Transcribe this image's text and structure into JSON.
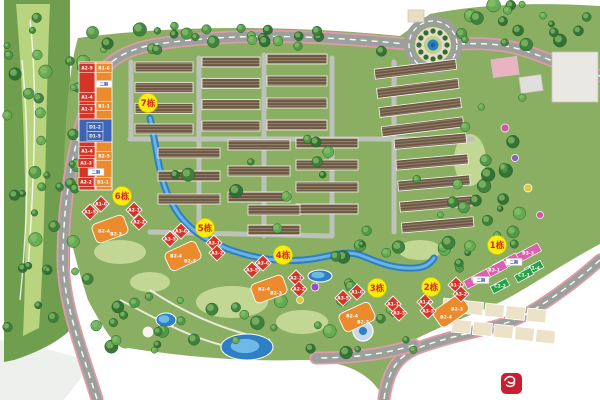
{
  "title": "residential-masterplan-site-plan",
  "colors": {
    "canvas": "#ffffff",
    "plan_green": "#8aaf62",
    "lawn_light": "#c9dc9b",
    "golf_dark": "#6f9e4f",
    "golf_fairway": "#b9d47f",
    "road_grey": "#9ba09b",
    "road_minor": "#bdc3ba",
    "road_pink_edge": "#e09aa8",
    "water_deep": "#2f7fc4",
    "water_light": "#6fb9e6",
    "roof_dark": "#6d5846",
    "roof_stripe": "#94816b",
    "unit_red": "#d63426",
    "unit_orange": "#ec8a2e",
    "unit_blue": "#3f63b5",
    "unit_pink": "#dd5fae",
    "unit_green": "#27a347",
    "terrace_beige": "#ece2c8",
    "marker_yellow": "#f7ee12",
    "marker_text": "#e0221a",
    "logo_red": "#c51f30",
    "tree_greens": [
      "#3c7f3a",
      "#4f9647",
      "#63ab52",
      "#2f6e33"
    ]
  },
  "markers": [
    {
      "label": "7栋",
      "x": 148,
      "y": 103
    },
    {
      "label": "6栋",
      "x": 122,
      "y": 196
    },
    {
      "label": "5栋",
      "x": 205,
      "y": 228
    },
    {
      "label": "4栋",
      "x": 283,
      "y": 255
    },
    {
      "label": "3栋",
      "x": 377,
      "y": 288
    },
    {
      "label": "2栋",
      "x": 431,
      "y": 287
    },
    {
      "label": "1栋",
      "x": 497,
      "y": 245
    }
  ],
  "tower_bars": [
    {
      "x": 79,
      "y": 62,
      "w": 16,
      "h": 128,
      "c": "red"
    },
    {
      "x": 96,
      "y": 62,
      "w": 16,
      "h": 128,
      "c": "orange"
    },
    {
      "x": 79,
      "y": 119,
      "w": 33,
      "h": 23,
      "c": "blue"
    }
  ],
  "tower_chips": [
    {
      "label": "A2-5",
      "x": 87,
      "y": 68,
      "c": "red"
    },
    {
      "label": "B1-6",
      "x": 104,
      "y": 68,
      "c": "orange"
    },
    {
      "label": "A1-4",
      "x": 87,
      "y": 97,
      "c": "red"
    },
    {
      "label": "A1-3",
      "x": 87,
      "y": 109,
      "c": "red"
    },
    {
      "label": "B1-1",
      "x": 104,
      "y": 106,
      "c": "orange"
    },
    {
      "label": "D1-2",
      "x": 95,
      "y": 127,
      "c": "blue"
    },
    {
      "label": "D1-5",
      "x": 95,
      "y": 136,
      "c": "blue"
    },
    {
      "label": "A1-4",
      "x": 87,
      "y": 151,
      "c": "red"
    },
    {
      "label": "B2-5",
      "x": 104,
      "y": 156,
      "c": "orange"
    },
    {
      "label": "A1-3",
      "x": 86,
      "y": 163,
      "c": "red"
    },
    {
      "label": "A2-2",
      "x": 86,
      "y": 182,
      "c": "red"
    },
    {
      "label": "B1-1",
      "x": 103,
      "y": 182,
      "c": "orange"
    }
  ],
  "diamonds": [
    {
      "label": "A1-6",
      "x": 101,
      "y": 204
    },
    {
      "label": "A1-5",
      "x": 90,
      "y": 212
    },
    {
      "label": "A2-1",
      "x": 134,
      "y": 210
    },
    {
      "label": "A2-2",
      "x": 139,
      "y": 222
    },
    {
      "label": "A3-6",
      "x": 181,
      "y": 231
    },
    {
      "label": "A3-5",
      "x": 170,
      "y": 239
    },
    {
      "label": "A3-1",
      "x": 214,
      "y": 243
    },
    {
      "label": "A3-2",
      "x": 217,
      "y": 253
    },
    {
      "label": "A3-6",
      "x": 263,
      "y": 263
    },
    {
      "label": "A3-5",
      "x": 252,
      "y": 270
    },
    {
      "label": "A2-1",
      "x": 296,
      "y": 278
    },
    {
      "label": "A2-2",
      "x": 299,
      "y": 289
    },
    {
      "label": "A1-6",
      "x": 357,
      "y": 292
    },
    {
      "label": "A3-5",
      "x": 343,
      "y": 298
    },
    {
      "label": "A1-1",
      "x": 393,
      "y": 304
    },
    {
      "label": "A3-3",
      "x": 399,
      "y": 313
    },
    {
      "label": "A1-1",
      "x": 456,
      "y": 285
    },
    {
      "label": "A3-2",
      "x": 461,
      "y": 294
    },
    {
      "label": "A1-6",
      "x": 425,
      "y": 302
    },
    {
      "label": "A3-5",
      "x": 428,
      "y": 311
    }
  ],
  "orange_blobs": [
    {
      "x": 110,
      "y": 229,
      "rot": -20
    },
    {
      "x": 183,
      "y": 256,
      "rot": -25
    },
    {
      "x": 269,
      "y": 289,
      "rot": -20
    },
    {
      "x": 357,
      "y": 317,
      "rot": -25
    },
    {
      "x": 451,
      "y": 311,
      "rot": -35
    }
  ],
  "orange_units": [
    {
      "label": "B2-4",
      "x": 104,
      "y": 231
    },
    {
      "label": "B2-3",
      "x": 116,
      "y": 234
    },
    {
      "label": "B2-4",
      "x": 176,
      "y": 256
    },
    {
      "label": "B2-3",
      "x": 190,
      "y": 261
    },
    {
      "label": "B2-4",
      "x": 264,
      "y": 289
    },
    {
      "label": "B2-3",
      "x": 276,
      "y": 293
    },
    {
      "label": "B2-4",
      "x": 352,
      "y": 316
    },
    {
      "label": "B2-3",
      "x": 363,
      "y": 322
    },
    {
      "label": "B2-3",
      "x": 457,
      "y": 309
    },
    {
      "label": "B2-4",
      "x": 446,
      "y": 317
    }
  ],
  "pink_blocks": [
    {
      "label": "B3-3",
      "x": 528,
      "y": 253
    },
    {
      "label": "B3-2",
      "x": 506,
      "y": 263
    },
    {
      "label": "B3-1",
      "x": 494,
      "y": 270
    },
    {
      "label": "B3-2",
      "x": 477,
      "y": 279
    }
  ],
  "green_blocks": [
    {
      "label": "C1-4",
      "x": 534,
      "y": 268
    },
    {
      "label": "C1-1",
      "x": 524,
      "y": 275
    },
    {
      "label": "C1-2",
      "x": 500,
      "y": 286
    }
  ],
  "phase_tags": [
    {
      "label": "二期",
      "x": 104,
      "y": 84
    },
    {
      "label": "二期",
      "x": 96,
      "y": 172
    },
    {
      "label": "二期",
      "x": 514,
      "y": 262
    },
    {
      "label": "二期",
      "x": 481,
      "y": 280
    }
  ],
  "map": {
    "base_blob": "M78,38 C180,24 300,26 400,36 L430,14 C480,4 540,2 600,6 L600,244 C566,262 540,280 512,296 C478,314 448,322 414,340 C400,350 392,368 386,399 L384,399 C370,370 340,360 300,360 C240,362 180,356 128,348 C118,352 104,330 88,300 C72,250 62,210 64,160 C66,110 70,64 78,38 Z",
    "corner_shade": "M0,340 C30,344 60,352 92,362 C80,380 70,392 64,400 L0,400 Z",
    "golf": {
      "outer": "M4,0 L70,0 L70,330 C56,344 32,354 14,360 L4,362 Z",
      "fairway": "M16,4 L50,4 C45,120 46,230 39,328 L23,336 C28,230 25,110 16,4 Z",
      "paths": [
        "M30,20 C38,90 34,180 28,270",
        "M22,60 C30,140 28,220 20,300"
      ]
    },
    "roads_main": [
      "M97,399 C80,345 63,302 63,258 C63,205 72,148 90,96 C98,68 118,50 158,44 C240,32 320,36 407,44",
      "M459,44 C500,42 520,48 545,58 C565,66 585,72 600,76",
      "M384,399 C388,370 398,356 418,348 C460,332 500,330 530,312 C560,294 582,276 600,260",
      "M414,345 C386,354 352,358 316,358"
    ],
    "roads_minor": [
      "M130,139 L472,139",
      "M199,58 L199,232",
      "M264,55 L264,236",
      "M332,58 L332,236",
      "M394,62 L394,232",
      "M131,62 L131,139",
      "M150,232 L330,236"
    ],
    "leisure_paths": [
      "M120,300 C160,320 200,346 260,352",
      "M150,290 C180,310 220,330 270,340"
    ],
    "stream": "M150,118 C158,152 158,180 174,207 C186,228 205,240 228,249 C258,260 285,263 312,259 C332,256 345,250 360,255 C378,262 392,269 414,268 C424,268 430,264 434,258",
    "ponds": [
      {
        "x": 247,
        "y": 347,
        "rx": 26,
        "ry": 13
      },
      {
        "x": 166,
        "y": 320,
        "rx": 10,
        "ry": 7
      },
      {
        "x": 320,
        "y": 276,
        "rx": 12,
        "ry": 6
      }
    ],
    "fountain": {
      "x": 363,
      "y": 331,
      "r": 10
    },
    "lawns": [
      {
        "x": 120,
        "y": 252,
        "rx": 26,
        "ry": 12
      },
      {
        "x": 232,
        "y": 302,
        "rx": 36,
        "ry": 16
      },
      {
        "x": 302,
        "y": 322,
        "rx": 26,
        "ry": 12
      },
      {
        "x": 150,
        "y": 282,
        "rx": 20,
        "ry": 10
      },
      {
        "x": 420,
        "y": 250,
        "rx": 22,
        "ry": 10
      },
      {
        "x": 470,
        "y": 160,
        "rx": 16,
        "ry": 26
      }
    ],
    "clusters": [
      {
        "x": 135,
        "y": 62,
        "w": 58,
        "h": 72,
        "rows": 4,
        "rot": 0
      },
      {
        "x": 202,
        "y": 57,
        "w": 58,
        "h": 74,
        "rows": 4,
        "rot": 0
      },
      {
        "x": 267,
        "y": 54,
        "w": 60,
        "h": 76,
        "rows": 4,
        "rot": 0
      },
      {
        "x": 378,
        "y": 64,
        "w": 82,
        "h": 68,
        "rows": 4,
        "rot": -7
      },
      {
        "x": 158,
        "y": 148,
        "w": 62,
        "h": 56,
        "rows": 3,
        "rot": 0
      },
      {
        "x": 228,
        "y": 140,
        "w": 62,
        "h": 62,
        "rows": 3,
        "rot": 0
      },
      {
        "x": 296,
        "y": 138,
        "w": 62,
        "h": 76,
        "rows": 4,
        "rot": 0
      },
      {
        "x": 398,
        "y": 136,
        "w": 72,
        "h": 94,
        "rows": 5,
        "rot": -5
      },
      {
        "x": 248,
        "y": 205,
        "w": 52,
        "h": 30,
        "rows": 2,
        "rot": 0
      }
    ],
    "terrace_rows": [
      {
        "sx": 443,
        "sy": 299,
        "n": 5,
        "dx": 21,
        "dy": 2.5,
        "w": 19,
        "h": 13,
        "rot": 6
      },
      {
        "sx": 452,
        "sy": 320,
        "n": 5,
        "dx": 21,
        "dy": 2.5,
        "w": 19,
        "h": 13,
        "rot": 6
      }
    ],
    "structures": [
      {
        "x": 552,
        "y": 52,
        "w": 46,
        "h": 50,
        "c": "#eae8e2",
        "rot": 0
      },
      {
        "x": 492,
        "y": 58,
        "w": 26,
        "h": 18,
        "c": "#e9b3c4",
        "rot": -8
      },
      {
        "x": 520,
        "y": 76,
        "w": 22,
        "h": 16,
        "c": "#e2dede",
        "rot": -8
      },
      {
        "x": 408,
        "y": 10,
        "w": 16,
        "h": 12,
        "c": "#e8dfc2",
        "rot": 0
      }
    ],
    "roundabout": {
      "cx": 433,
      "cy": 45
    },
    "amenities": [
      {
        "x": 505,
        "y": 128,
        "c": "#cf58a6",
        "r": 4
      },
      {
        "x": 515,
        "y": 158,
        "c": "#8a5fb8",
        "r": 3.5
      },
      {
        "x": 528,
        "y": 188,
        "c": "#e0c93f",
        "r": 4
      },
      {
        "x": 540,
        "y": 215,
        "c": "#cf58a6",
        "r": 3.5
      },
      {
        "x": 315,
        "y": 287,
        "c": "#9a4fc0",
        "r": 4
      },
      {
        "x": 300,
        "y": 300,
        "c": "#d8c840",
        "r": 3.5
      },
      {
        "x": 148,
        "y": 332,
        "c": "#f5f3ec",
        "r": 5
      }
    ],
    "tree_zones": [
      {
        "x": 88,
        "y": 26,
        "w": 300,
        "h": 26,
        "n": 26
      },
      {
        "x": 450,
        "y": 4,
        "w": 146,
        "h": 42,
        "n": 18
      },
      {
        "x": 66,
        "y": 60,
        "w": 26,
        "h": 250,
        "n": 22
      },
      {
        "x": 95,
        "y": 290,
        "w": 340,
        "h": 66,
        "n": 34
      },
      {
        "x": 455,
        "y": 95,
        "w": 70,
        "h": 160,
        "n": 20
      },
      {
        "x": 140,
        "y": 135,
        "w": 330,
        "h": 100,
        "n": 16
      },
      {
        "x": 2,
        "y": 4,
        "w": 64,
        "h": 330,
        "n": 30
      },
      {
        "x": 330,
        "y": 240,
        "w": 130,
        "h": 50,
        "n": 14
      }
    ]
  },
  "logo": {
    "x": 501,
    "y": 373,
    "bg": "#c51f30"
  }
}
